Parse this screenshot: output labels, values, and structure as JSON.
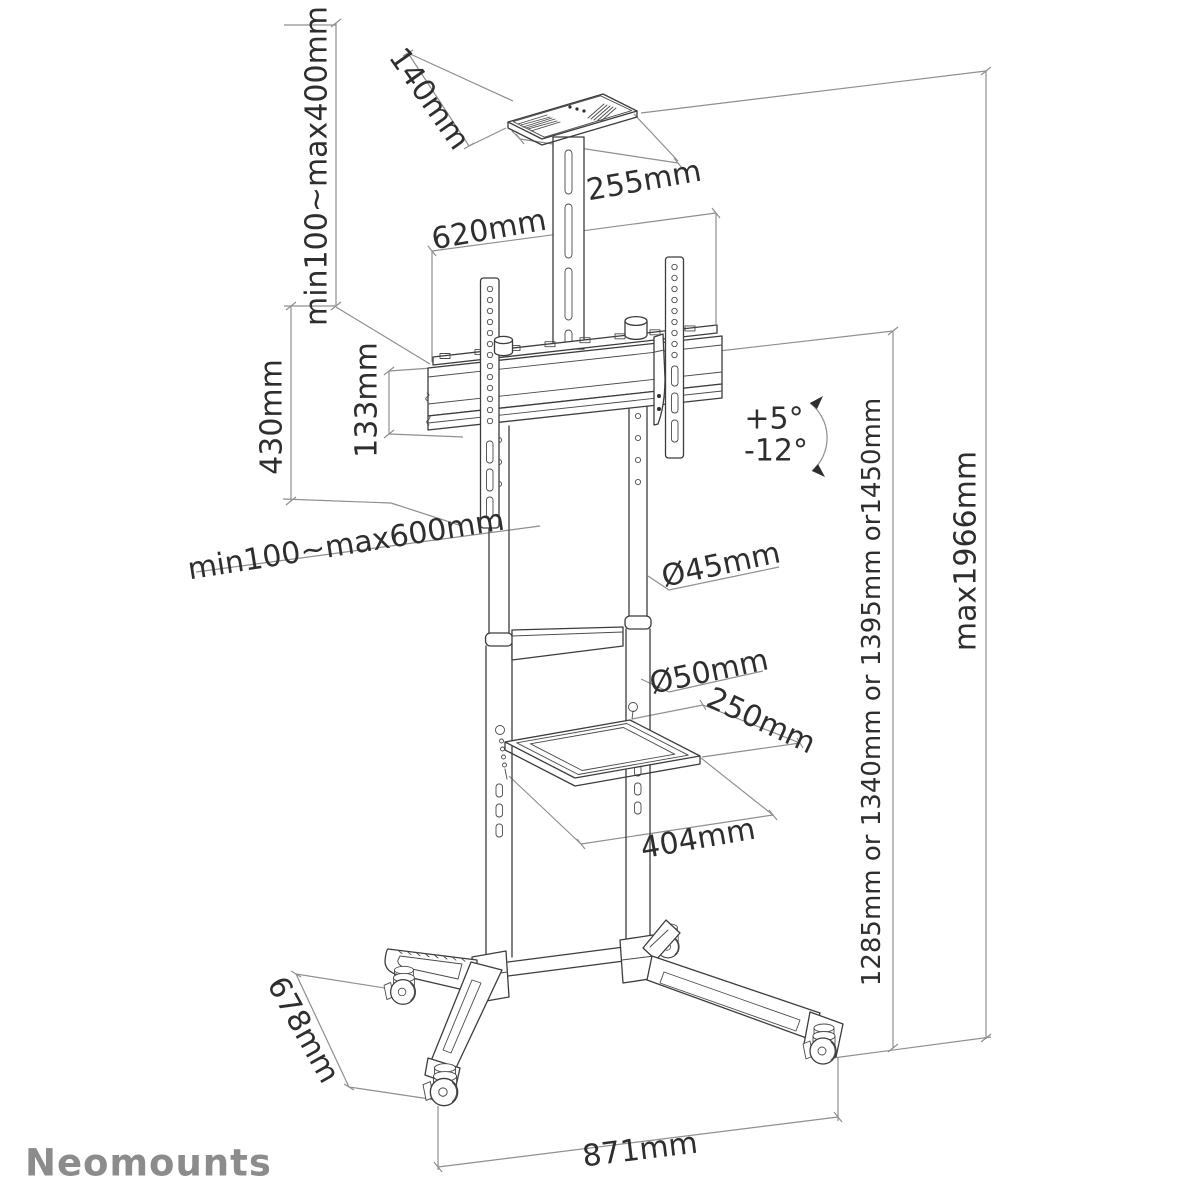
{
  "brand": "Neomounts",
  "annotations": {
    "tray_height_range": "min100~max400mm",
    "tray_depth": "140mm",
    "tray_width": "255mm",
    "crossbar_width": "620mm",
    "bracket_height": "430mm",
    "rail_spacing": "133mm",
    "vesa_width_range": "min100~max600mm",
    "tilt_up": "+5°",
    "tilt_down": "-12°",
    "upper_column_diameter": "Ø45mm",
    "lower_column_diameter": "Ø50mm",
    "shelf_depth": "250mm",
    "shelf_width": "404mm",
    "column_heights": "1285mm or 1340mm or 1395mm or1450mm",
    "max_height": "max1966mm",
    "base_depth": "678mm",
    "base_width": "871mm"
  }
}
